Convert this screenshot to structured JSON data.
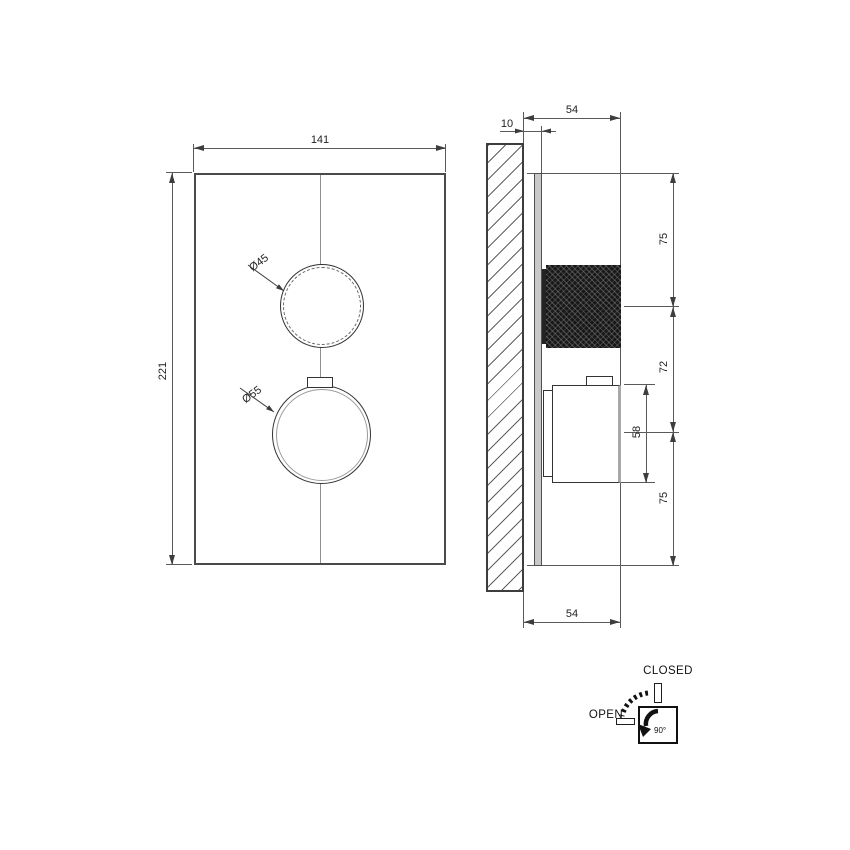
{
  "drawing": {
    "front_view": {
      "width_dim": "141",
      "height_dim": "221",
      "top_knob_diameter": "Ø45",
      "bottom_knob_diameter": "Ø55"
    },
    "side_view": {
      "plate_offset_dim": "10",
      "depth_dim_top": "54",
      "depth_dim_bottom": "54",
      "chain_dims": [
        {
          "value": "75"
        },
        {
          "value": "72"
        },
        {
          "value": "75"
        }
      ],
      "handle_height_dim": "58"
    },
    "legend": {
      "closed_label": "CLOSED",
      "open_label": "OPEN",
      "rotation_angle": "90°"
    },
    "colors": {
      "line": "#4a4a4a",
      "dim_line": "#5a5a5a",
      "knob_dark": "#181818",
      "plate_side_fill": "#c9c9c9",
      "background": "#ffffff"
    }
  }
}
